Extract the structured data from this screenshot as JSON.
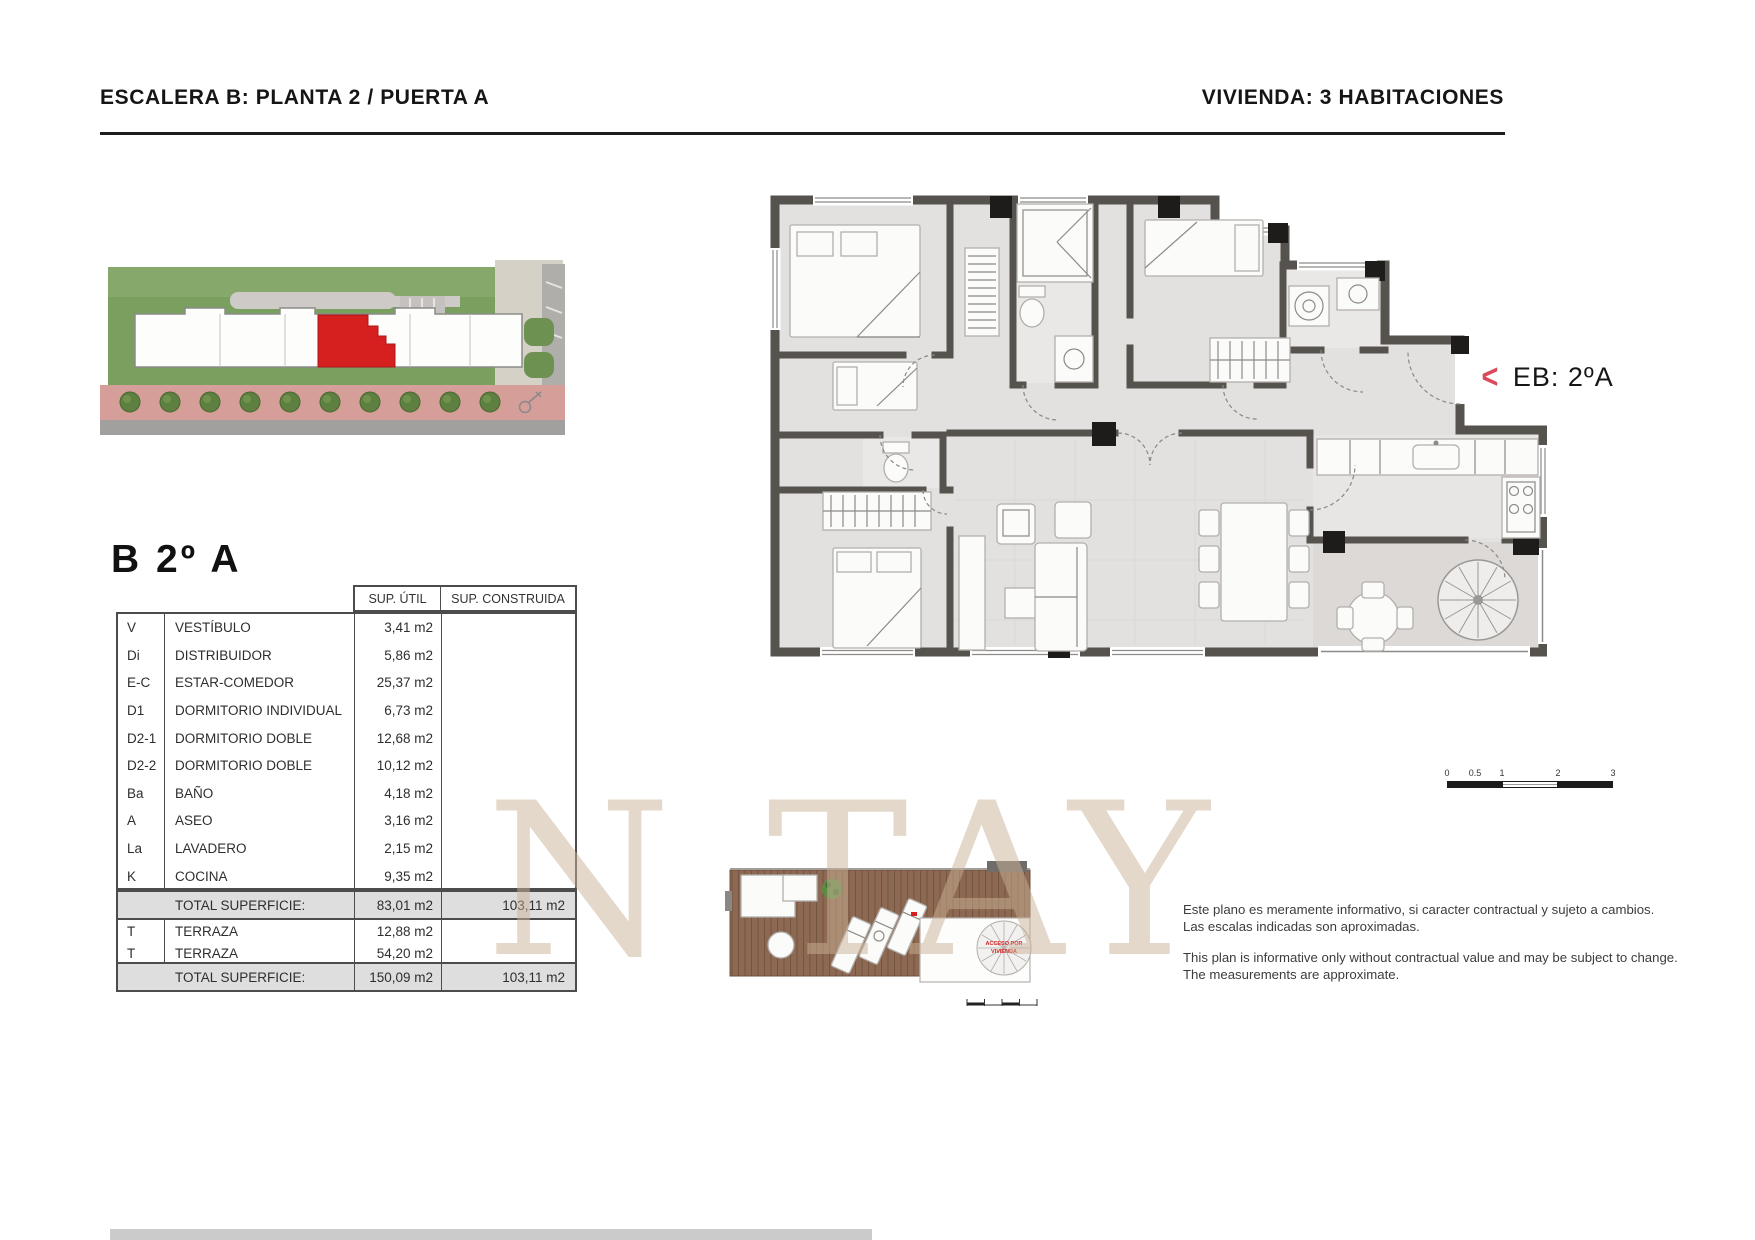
{
  "header": {
    "left": "ESCALERA B: PLANTA 2 / PUERTA A",
    "right": "VIVIENDA: 3 HABITACIONES"
  },
  "unit": {
    "title": "B 2º A",
    "plan_label": "EB: 2ºA"
  },
  "table": {
    "headers": {
      "sup_util": "SUP. ÚTIL",
      "sup_construida": "SUP. CONSTRUIDA"
    },
    "rooms": [
      {
        "code": "V",
        "name": "VESTÍBULO",
        "sup_util": "3,41 m2",
        "sup_construida": ""
      },
      {
        "code": "Di",
        "name": "DISTRIBUIDOR",
        "sup_util": "5,86 m2",
        "sup_construida": ""
      },
      {
        "code": "E-C",
        "name": "ESTAR-COMEDOR",
        "sup_util": "25,37 m2",
        "sup_construida": ""
      },
      {
        "code": "D1",
        "name": "DORMITORIO INDIVIDUAL",
        "sup_util": "6,73 m2",
        "sup_construida": ""
      },
      {
        "code": "D2-1",
        "name": "DORMITORIO DOBLE",
        "sup_util": "12,68 m2",
        "sup_construida": ""
      },
      {
        "code": "D2-2",
        "name": "DORMITORIO DOBLE",
        "sup_util": "10,12 m2",
        "sup_construida": ""
      },
      {
        "code": "Ba",
        "name": "BAÑO",
        "sup_util": "4,18 m2",
        "sup_construida": ""
      },
      {
        "code": "A",
        "name": "ASEO",
        "sup_util": "3,16 m2",
        "sup_construida": ""
      },
      {
        "code": "La",
        "name": "LAVADERO",
        "sup_util": "2,15 m2",
        "sup_construida": ""
      },
      {
        "code": "K",
        "name": "COCINA",
        "sup_util": "9,35 m2",
        "sup_construida": ""
      }
    ],
    "total_interior": {
      "label": "TOTAL SUPERFICIE:",
      "sup_util": "83,01 m2",
      "sup_construida": "103,11 m2"
    },
    "terraces": [
      {
        "code": "T",
        "name": "TERRAZA",
        "sup_util": "12,88 m2",
        "sup_construida": ""
      },
      {
        "code": "T",
        "name": "TERRAZA",
        "sup_util": "54,20 m2",
        "sup_construida": ""
      }
    ],
    "total_overall": {
      "label": "TOTAL SUPERFICIE:",
      "sup_util": "150,09 m2",
      "sup_construida": "103,11 m2"
    }
  },
  "plan": {
    "scale_labels": [
      "0",
      "0.5",
      "1",
      "2",
      "3"
    ]
  },
  "terrace_plan": {
    "access_line1": "ACCESO POR",
    "access_line2": "VIVIENDA"
  },
  "watermark": "N TAY",
  "disclaimer": {
    "es1": "Este plano es meramente informativo, si caracter contractual y sujeto a cambios.",
    "es2": "Las escalas indicadas son aproximadas.",
    "en1": "This plan is informative only without contractual value and may be subject to change.",
    "en2": "The measurements are approximate."
  },
  "colors": {
    "accent_red": "#d94b5c",
    "unit_red": "#d5201f",
    "wall": "#56524e",
    "watermark": "#c9b298",
    "total_row_bg": "#dedede"
  }
}
